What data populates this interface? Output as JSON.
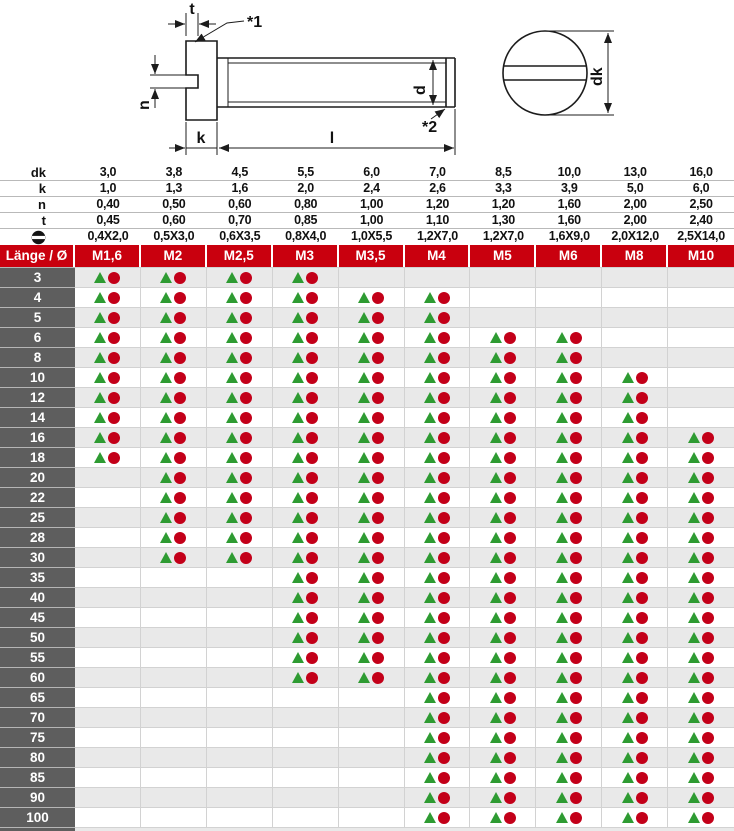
{
  "drawing": {
    "labels": {
      "t": "t",
      "star1": "*1",
      "n": "n",
      "k": "k",
      "l": "l",
      "d": "d",
      "star2": "*2",
      "dk": "dk"
    }
  },
  "spec_rows": [
    {
      "label": "dk",
      "values": [
        "3,0",
        "3,8",
        "4,5",
        "5,5",
        "6,0",
        "7,0",
        "8,5",
        "10,0",
        "13,0",
        "16,0"
      ]
    },
    {
      "label": "k",
      "values": [
        "1,0",
        "1,3",
        "1,6",
        "2,0",
        "2,4",
        "2,6",
        "3,3",
        "3,9",
        "5,0",
        "6,0"
      ]
    },
    {
      "label": "n",
      "values": [
        "0,40",
        "0,50",
        "0,60",
        "0,80",
        "1,00",
        "1,20",
        "1,20",
        "1,60",
        "2,00",
        "2,50"
      ]
    },
    {
      "label": "t",
      "values": [
        "0,45",
        "0,60",
        "0,70",
        "0,85",
        "1,00",
        "1,10",
        "1,30",
        "1,60",
        "2,00",
        "2,40"
      ]
    },
    {
      "icon": "slot-head-icon",
      "values": [
        "0,4X2,0",
        "0,5X3,0",
        "0,6X3,5",
        "0,8X4,0",
        "1,0X5,5",
        "1,2X7,0",
        "1,2X7,0",
        "1,6X9,0",
        "2,0X12,0",
        "2,5X14,0"
      ]
    }
  ],
  "table": {
    "corner_label": "Länge / Ø",
    "columns": [
      "M1,6",
      "M2",
      "M2,5",
      "M3",
      "M3,5",
      "M4",
      "M5",
      "M6",
      "M8",
      "M10"
    ],
    "mark_legend": {
      "triangle": "triangle-mark",
      "circle": "circle-mark"
    },
    "rows": [
      {
        "length": "3",
        "available": [
          1,
          1,
          1,
          1,
          0,
          0,
          0,
          0,
          0,
          0
        ]
      },
      {
        "length": "4",
        "available": [
          1,
          1,
          1,
          1,
          1,
          1,
          0,
          0,
          0,
          0
        ]
      },
      {
        "length": "5",
        "available": [
          1,
          1,
          1,
          1,
          1,
          1,
          0,
          0,
          0,
          0
        ]
      },
      {
        "length": "6",
        "available": [
          1,
          1,
          1,
          1,
          1,
          1,
          1,
          1,
          0,
          0
        ]
      },
      {
        "length": "8",
        "available": [
          1,
          1,
          1,
          1,
          1,
          1,
          1,
          1,
          0,
          0
        ]
      },
      {
        "length": "10",
        "available": [
          1,
          1,
          1,
          1,
          1,
          1,
          1,
          1,
          1,
          0
        ]
      },
      {
        "length": "12",
        "available": [
          1,
          1,
          1,
          1,
          1,
          1,
          1,
          1,
          1,
          0
        ]
      },
      {
        "length": "14",
        "available": [
          1,
          1,
          1,
          1,
          1,
          1,
          1,
          1,
          1,
          0
        ]
      },
      {
        "length": "16",
        "available": [
          1,
          1,
          1,
          1,
          1,
          1,
          1,
          1,
          1,
          1
        ]
      },
      {
        "length": "18",
        "available": [
          1,
          1,
          1,
          1,
          1,
          1,
          1,
          1,
          1,
          1
        ]
      },
      {
        "length": "20",
        "available": [
          0,
          1,
          1,
          1,
          1,
          1,
          1,
          1,
          1,
          1
        ]
      },
      {
        "length": "22",
        "available": [
          0,
          1,
          1,
          1,
          1,
          1,
          1,
          1,
          1,
          1
        ]
      },
      {
        "length": "25",
        "available": [
          0,
          1,
          1,
          1,
          1,
          1,
          1,
          1,
          1,
          1
        ]
      },
      {
        "length": "28",
        "available": [
          0,
          1,
          1,
          1,
          1,
          1,
          1,
          1,
          1,
          1
        ]
      },
      {
        "length": "30",
        "available": [
          0,
          1,
          1,
          1,
          1,
          1,
          1,
          1,
          1,
          1
        ]
      },
      {
        "length": "35",
        "available": [
          0,
          0,
          0,
          1,
          1,
          1,
          1,
          1,
          1,
          1
        ]
      },
      {
        "length": "40",
        "available": [
          0,
          0,
          0,
          1,
          1,
          1,
          1,
          1,
          1,
          1
        ]
      },
      {
        "length": "45",
        "available": [
          0,
          0,
          0,
          1,
          1,
          1,
          1,
          1,
          1,
          1
        ]
      },
      {
        "length": "50",
        "available": [
          0,
          0,
          0,
          1,
          1,
          1,
          1,
          1,
          1,
          1
        ]
      },
      {
        "length": "55",
        "available": [
          0,
          0,
          0,
          1,
          1,
          1,
          1,
          1,
          1,
          1
        ]
      },
      {
        "length": "60",
        "available": [
          0,
          0,
          0,
          1,
          1,
          1,
          1,
          1,
          1,
          1
        ]
      },
      {
        "length": "65",
        "available": [
          0,
          0,
          0,
          0,
          0,
          1,
          1,
          1,
          1,
          1
        ]
      },
      {
        "length": "70",
        "available": [
          0,
          0,
          0,
          0,
          0,
          1,
          1,
          1,
          1,
          1
        ]
      },
      {
        "length": "75",
        "available": [
          0,
          0,
          0,
          0,
          0,
          1,
          1,
          1,
          1,
          1
        ]
      },
      {
        "length": "80",
        "available": [
          0,
          0,
          0,
          0,
          0,
          1,
          1,
          1,
          1,
          1
        ]
      },
      {
        "length": "85",
        "available": [
          0,
          0,
          0,
          0,
          0,
          1,
          1,
          1,
          1,
          1
        ]
      },
      {
        "length": "90",
        "available": [
          0,
          0,
          0,
          0,
          0,
          1,
          1,
          1,
          1,
          1
        ]
      },
      {
        "length": "100",
        "available": [
          0,
          0,
          0,
          0,
          0,
          1,
          1,
          1,
          1,
          1
        ]
      }
    ]
  },
  "colors": {
    "header_red": "#c9000e",
    "label_gray": "#5e5e5e",
    "stripe_gray": "#e9e9e9",
    "mark_green": "#2e9b32",
    "mark_red": "#c30019",
    "drawing_line": "#1c1c1c"
  }
}
